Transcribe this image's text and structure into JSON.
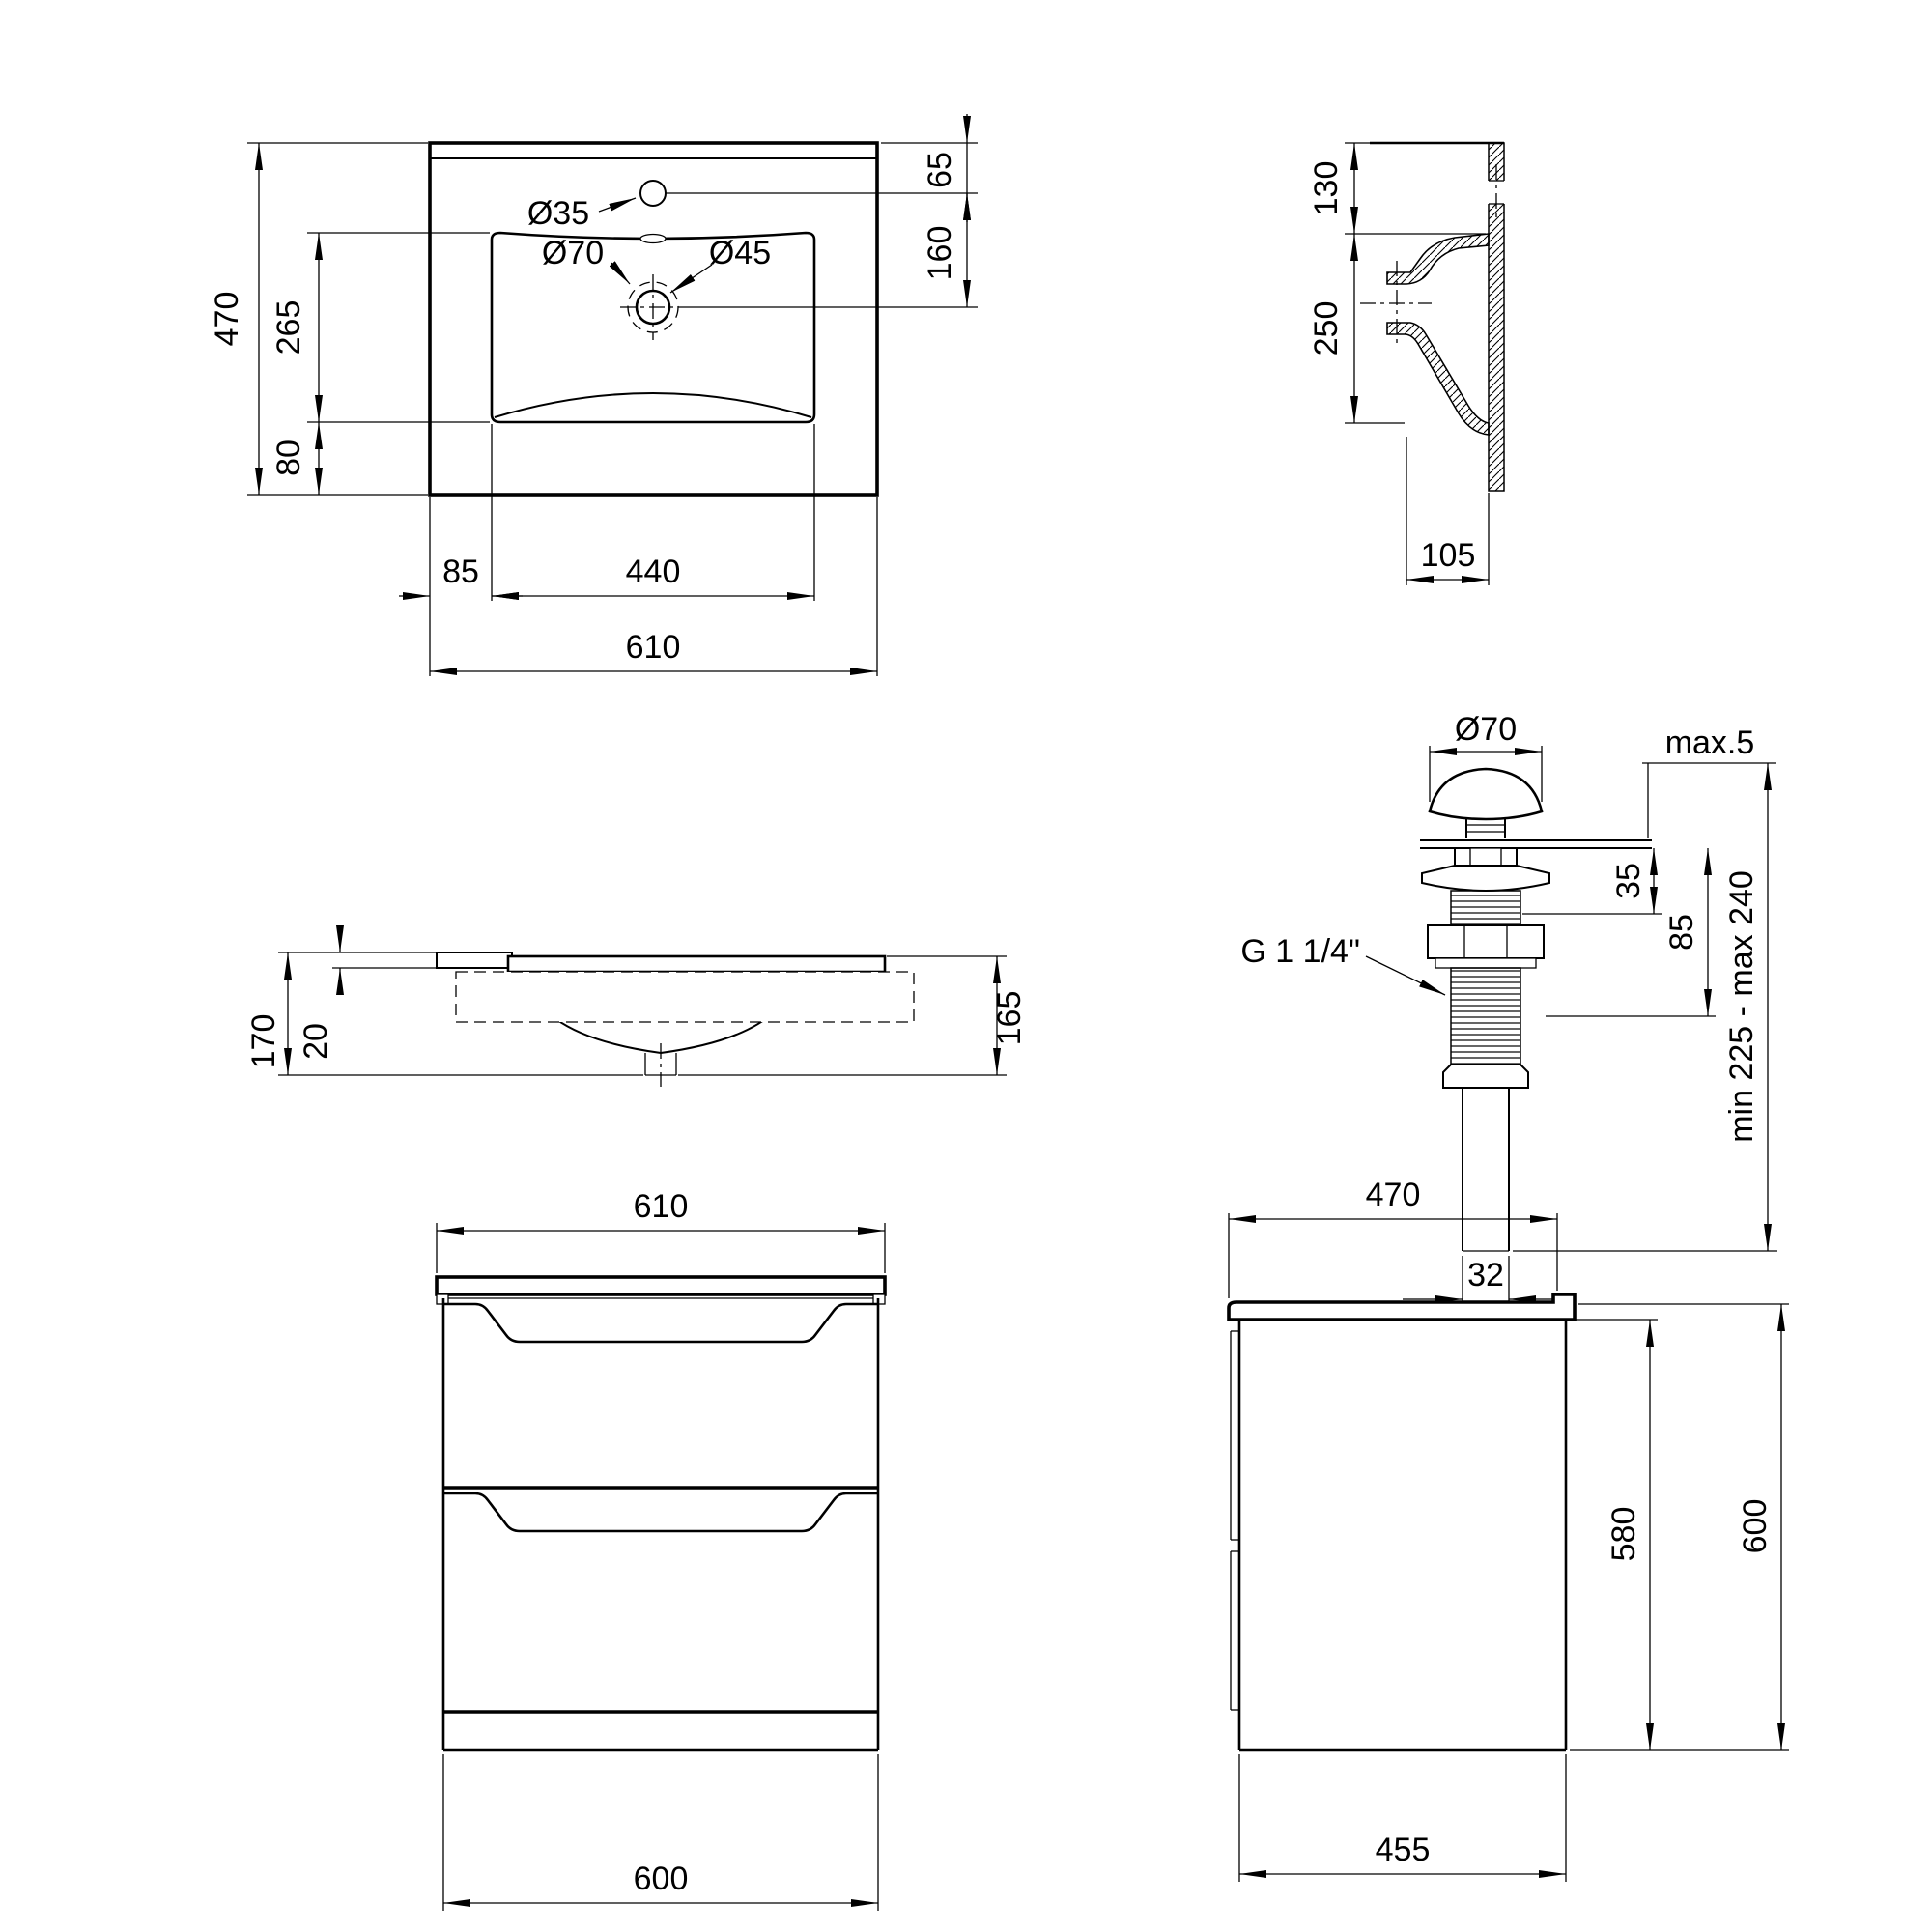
{
  "drawing": {
    "sink_top_view": {
      "overall_height": "470",
      "basin_height": "265",
      "basin_bottom_offset": "80",
      "faucet_hole_diameter": "Ø35",
      "drain_outer_diameter": "Ø70",
      "drain_diameter": "Ø45",
      "faucet_offset": "65",
      "faucet_to_drain": "160",
      "basin_side_margin": "85",
      "basin_width": "440",
      "overall_width": "610"
    },
    "sink_section_view": {
      "rim_height": "130",
      "bowl_depth": "250",
      "base_depth": "105"
    },
    "sink_front_view": {
      "total_height": "170",
      "slab_thickness": "20",
      "right_height": "165"
    },
    "drain_view": {
      "cap_diameter": "Ø70",
      "max_deck": "max.5",
      "upper_height": "35",
      "body_height": "85",
      "thread_label": "G 1 1/4\"",
      "length_range": "min 225 - max 240",
      "pipe_diameter": "32"
    },
    "cabinet_front_view": {
      "top_width": "610",
      "body_width": "600"
    },
    "cabinet_side_view": {
      "top_depth": "470",
      "body_height": "580",
      "total_height": "600",
      "body_depth": "455"
    }
  }
}
